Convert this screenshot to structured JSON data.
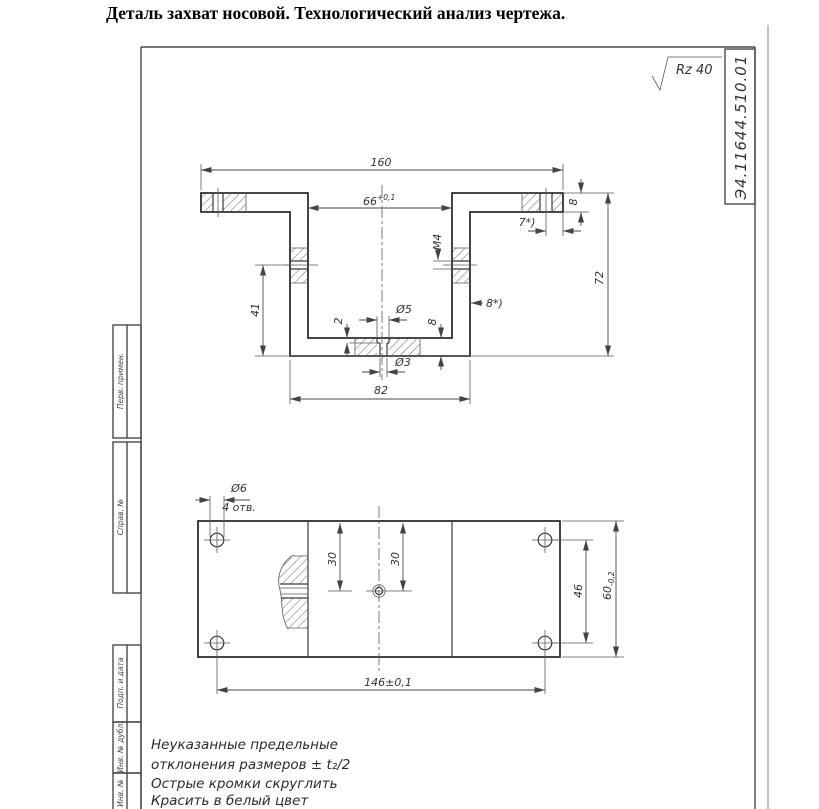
{
  "title": "Деталь захват носовой. Технологический анализ чертежа.",
  "frame": {
    "roughness_label": "Rz 40",
    "doc_number": "Э4.11644.510.01",
    "stamp_fields": [
      {
        "label": "Перв. примен."
      },
      {
        "label": "Справ. №"
      },
      {
        "label": "Подп. и дата"
      },
      {
        "label": "Инв. № дубл."
      },
      {
        "label": "Инв. №"
      }
    ]
  },
  "front_view": {
    "width_total": "160",
    "opening_width": "66",
    "opening_width_tol": "+0,1",
    "depth_to_axis": "41",
    "cbore_depth": "2",
    "cbore_dia": "Ø5",
    "base_thickness": "8",
    "thread_spec": "М4",
    "wall_ref": "8*)",
    "edge_ref": "7*)",
    "flange_thickness": "8",
    "height_total": "72",
    "base_width": "82",
    "hole_dia": "Ø3"
  },
  "plan_view": {
    "hole_dia": "Ø6",
    "hole_count": "4 отв.",
    "offset_left": "30",
    "offset_right": "30",
    "hole_spacing_v": "46",
    "height": "60",
    "height_tol": "-0,2",
    "hole_spacing_h": "146±0,1"
  },
  "notes": {
    "line1": "Неуказанные предельные",
    "line2": "отклонения размеров ± t₂/2",
    "line3": "Острые кромки скруглить",
    "line4": "Красить в белый цвет"
  }
}
